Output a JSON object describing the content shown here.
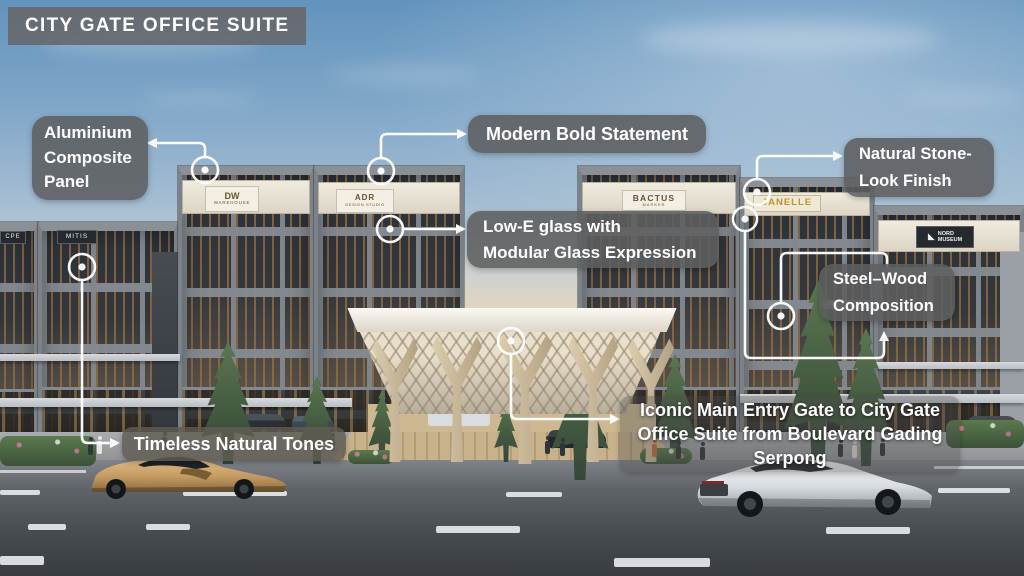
{
  "title": "CITY GATE OFFICE SUITE",
  "annotations": {
    "aluminium": {
      "lines": [
        "Aluminium",
        "Composite",
        "Panel"
      ]
    },
    "modern": {
      "lines": [
        "Modern Bold Statement"
      ]
    },
    "lowe": {
      "lines": [
        "Low-E glass with",
        "Modular Glass Expression"
      ]
    },
    "stone": {
      "lines": [
        "Natural Stone-",
        "Look Finish"
      ]
    },
    "steelwood": {
      "lines": [
        "Steel–Wood",
        "Composition"
      ]
    },
    "timeless": {
      "lines": [
        "Timeless Natural Tones"
      ]
    },
    "iconic": {
      "lines": [
        "Iconic Main Entry Gate to City Gate",
        "Office Suite from Boulevard Gading",
        "Serpong"
      ]
    }
  },
  "signs": {
    "far_left": "CPE",
    "mitis": "MITIS",
    "dw": [
      "DW",
      "WAREHOUSE"
    ],
    "adr": [
      "ADR",
      "DESIGN STUDIO"
    ],
    "bactus": [
      "BACTUS",
      "MARKER"
    ],
    "janelle": "JANELLE",
    "nord": [
      "NORD",
      "MUSEUM"
    ]
  },
  "colors": {
    "label_bg": "#5d5e60",
    "label_text": "#ffffff",
    "connector": "#ffffff",
    "sky_top": "#6293bd",
    "sunset_glow": "#f6ddb2",
    "facade_frame": "#7c8288",
    "wood_slat": "#9b7040",
    "canopy": "#efe8d8",
    "road": "#4b5054",
    "gold_car": "#c49a62",
    "white_car": "#dde1e4",
    "tree": "#4a6348"
  }
}
